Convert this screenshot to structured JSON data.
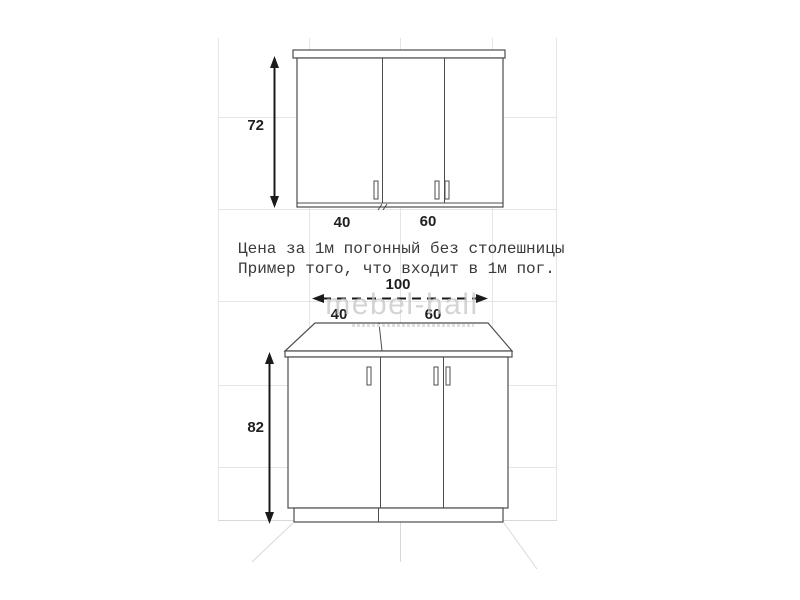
{
  "caption": {
    "line1": "Цена за 1м погонный без столешницы",
    "line2": "Пример того, что входит в 1м пог."
  },
  "upper_cabinet": {
    "height": "72",
    "left_door_width": "40",
    "right_door_width": "60"
  },
  "lower_cabinet": {
    "total_width": "100",
    "left_module_width": "40",
    "right_module_width": "60",
    "height": "82"
  },
  "watermark": {
    "text": "mebel-hall"
  },
  "colors": {
    "outline": "#4d4d4d",
    "dimension_text": "#1f1f1f",
    "tile_line": "#e5e5e1",
    "watermark": "#c4c4c4"
  }
}
